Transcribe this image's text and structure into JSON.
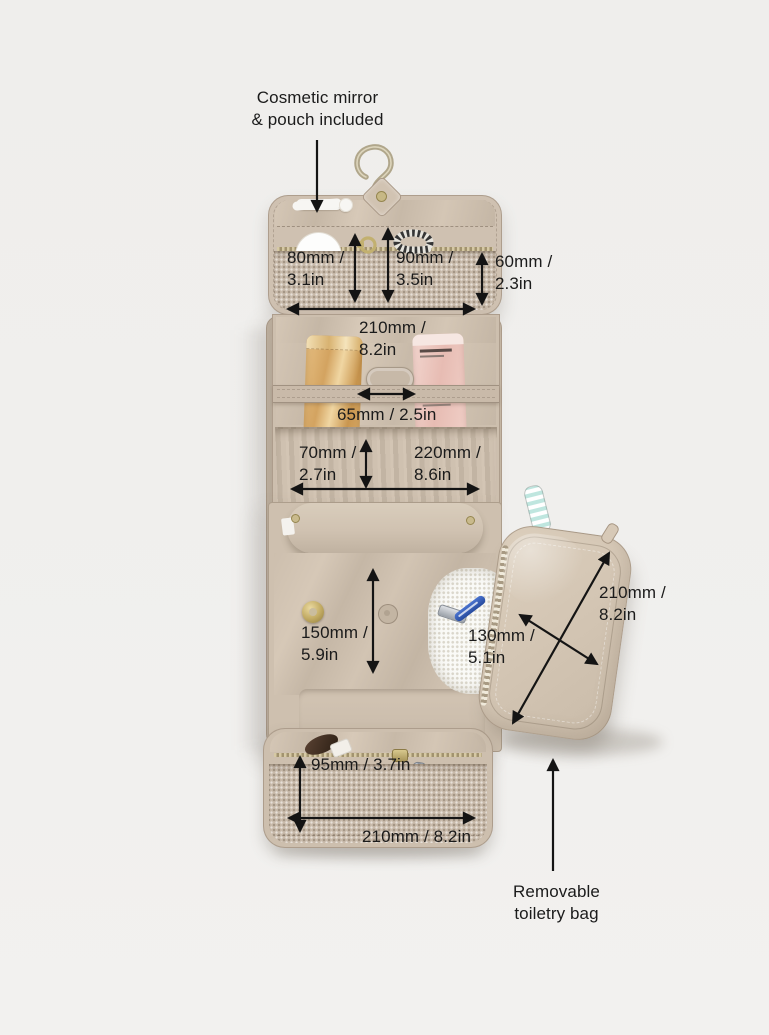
{
  "notes": {
    "top": {
      "line1": "Cosmetic mirror",
      "line2": "& pouch included"
    },
    "bottom": {
      "line1": "Removable",
      "line2": "toiletry bag"
    }
  },
  "measurements": {
    "flap_mirror_pocket": {
      "line1": "80mm /",
      "line2": "3.1in"
    },
    "flap_zip_pocket": {
      "line1": "90mm /",
      "line2": "3.5in"
    },
    "flap_side_depth": {
      "line1": "60mm /",
      "line2": "2.3in"
    },
    "flap_width": {
      "line1": "210mm /",
      "line2": "8.2in"
    },
    "elastic_strap_gap": {
      "text": "65mm / 2.5in"
    },
    "elastic_loop_depth": {
      "line1": "70mm /",
      "line2": "2.7in"
    },
    "middle_width": {
      "line1": "220mm /",
      "line2": "8.6in"
    },
    "main_compartment_height": {
      "line1": "150mm /",
      "line2": "5.9in"
    },
    "pouch_width": {
      "line1": "130mm /",
      "line2": "5.1in"
    },
    "pouch_length": {
      "line1": "210mm /",
      "line2": "8.2in"
    },
    "bottom_pocket_depth": {
      "text": "95mm / 3.7in"
    },
    "bottom_width": {
      "text": "210mm / 8.2in"
    }
  },
  "colors": {
    "background": "#f0efed",
    "fabric_beige": "#cdbfae",
    "fabric_dark": "#c6b8a7",
    "mesh": "#c9bbab",
    "annotation_ink": "#161616",
    "hook_brass": "#b4aa90",
    "gold_tube": "#d9a96a",
    "pink_tube": "#ecc8c0",
    "razor_blue": "#2e57b0",
    "toothbrush_mint": "#bfe6df"
  }
}
